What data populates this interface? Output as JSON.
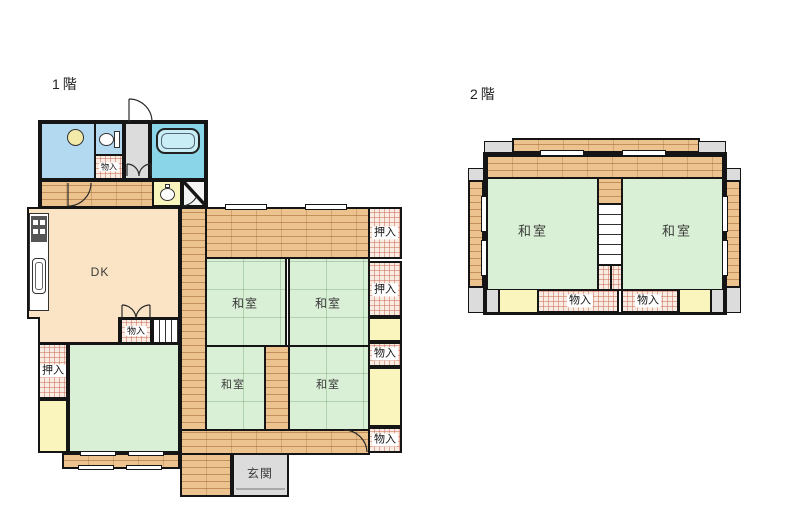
{
  "plan_type": "japanese-residential-floor-plan",
  "floor1": {
    "title": "1階",
    "labels": {
      "dk": "DK",
      "washitsu": "和室",
      "genkan": "玄関",
      "oshiire": "押入",
      "monoire": "物入"
    }
  },
  "floor2": {
    "title": "2階",
    "labels": {
      "washitsu": "和室",
      "monoire": "物入"
    }
  },
  "colors": {
    "wall": "#151515",
    "tatami_green": "#d9f0d6",
    "wood_floor": "#ecc28e",
    "dk_peach": "#fbe4c5",
    "closet_pink": "#f9ece3",
    "closet_grid_line": "#cd6e5a",
    "service_yellow": "#f9f5bd",
    "washroom_blue": "#b3d9f1",
    "bath_cyan": "#8ad5e8",
    "genkan_gray": "#dcdcdc",
    "background": "#ffffff"
  }
}
